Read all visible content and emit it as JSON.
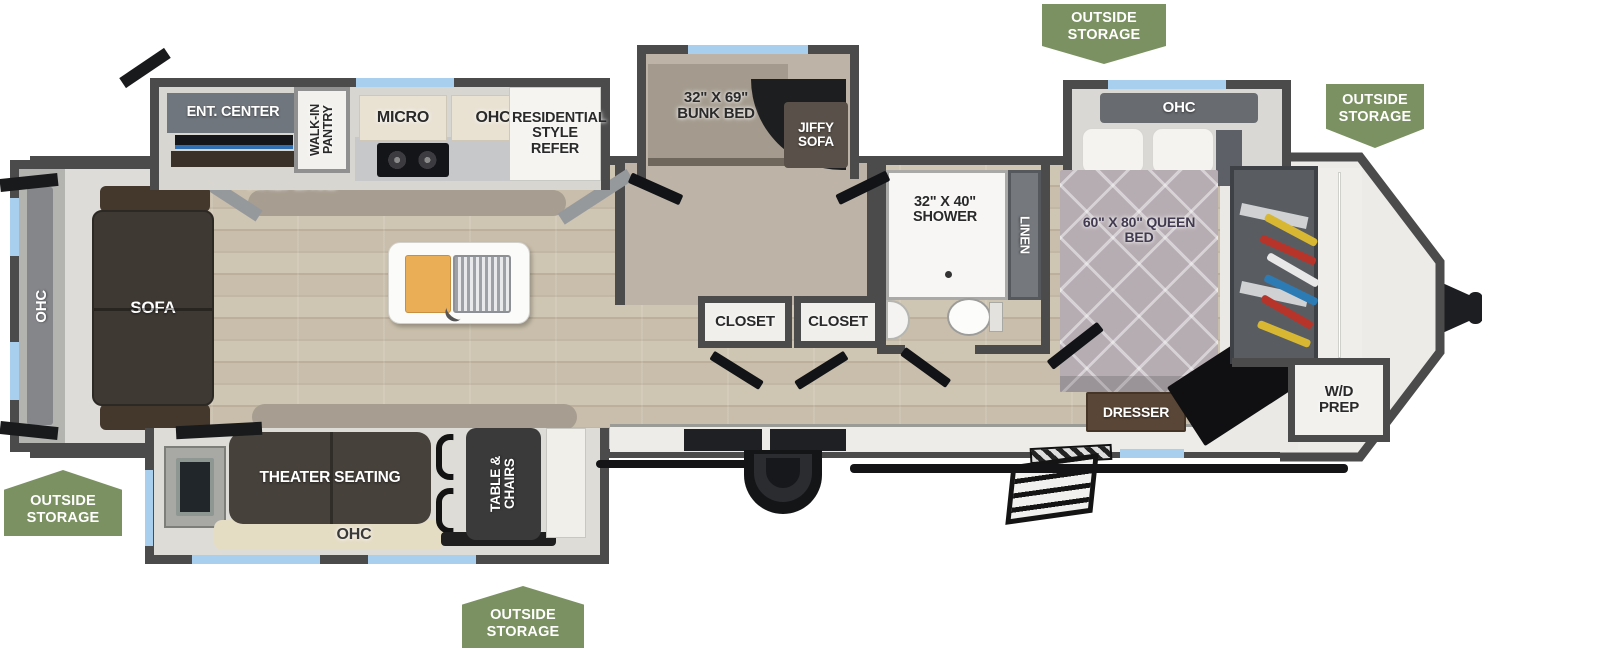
{
  "floorplan": {
    "badges": [
      {
        "id": "top",
        "label": "OUTSIDE STORAGE"
      },
      {
        "id": "front-right",
        "label": "OUTSIDE STORAGE"
      },
      {
        "id": "rear-bottom",
        "label": "OUTSIDE STORAGE"
      },
      {
        "id": "bottom-center",
        "label": "OUTSIDE STORAGE"
      }
    ],
    "kitchen": {
      "ent_center": "ENT. CENTER",
      "fireplace": "FIREPLACE",
      "walk_in_pantry": "WALK-IN PANTRY",
      "micro": "MICRO",
      "ohc": "OHC",
      "refer": "RESIDENTIAL STYLE REFER"
    },
    "living": {
      "ohc": "OHC",
      "sofa": "SOFA"
    },
    "dinette": {
      "theater_seating": "THEATER SEATING",
      "ohc": "OHC",
      "table_chairs": "TABLE & CHAIRS"
    },
    "bunk_room": {
      "bunk_bed": "32\" X 69\" BUNK BED",
      "jiffy_sofa": "JIFFY SOFA",
      "closet_left": "CLOSET",
      "closet_right": "CLOSET"
    },
    "bathroom": {
      "shower": "32\" X 40\" SHOWER",
      "linen": "LINEN"
    },
    "bedroom": {
      "ohc": "OHC",
      "queen_bed": "60\" X 80\" QUEEN BED",
      "dresser": "DRESSER"
    },
    "front": {
      "wd_prep": "W/D PREP"
    },
    "colors": {
      "badge_green": "#7b9162",
      "wall_gray": "#4b4b4b",
      "window_blue": "#a9cfee",
      "floor_wood": "#cbc0ae",
      "flame_accent": "#e8590c"
    }
  }
}
